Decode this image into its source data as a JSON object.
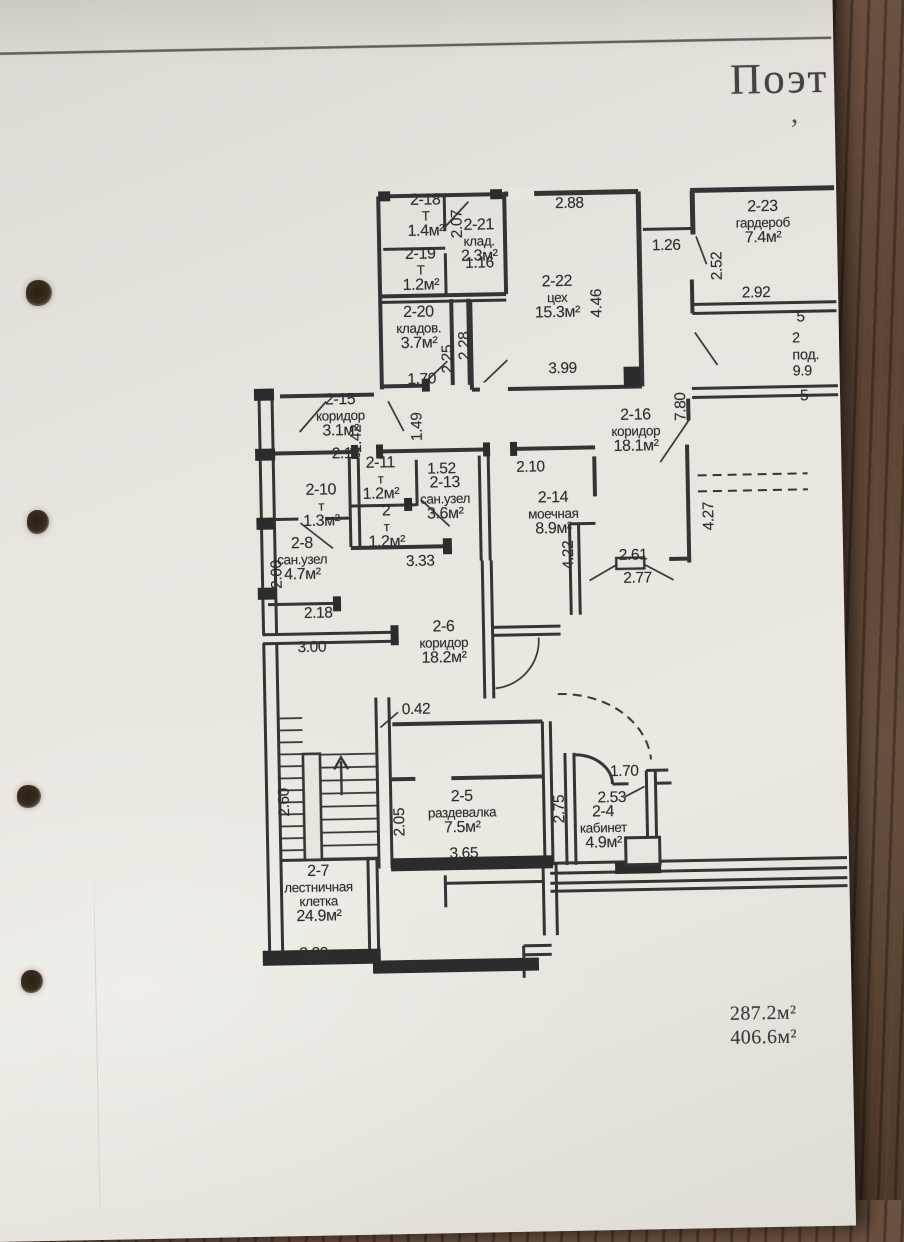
{
  "document": {
    "title_partial": "Поэт",
    "stray_mark": ",",
    "totals": {
      "line1": "287.2м²",
      "line2": "406.6м²"
    }
  },
  "plan": {
    "ink_color": "#343434",
    "rooms": [
      {
        "num": "2-18",
        "label": "Т",
        "area": "1.4м²",
        "x": 433,
        "y": 193
      },
      {
        "num": "2-19",
        "label": "Т",
        "area": "1.2м²",
        "x": 427,
        "y": 247
      },
      {
        "num": "2-21",
        "label": "клад.",
        "area": "2.3м²",
        "x": 486,
        "y": 219
      },
      {
        "num": "2-20",
        "label": "кладов.",
        "area": "3.7м²",
        "x": 424,
        "y": 305
      },
      {
        "num": "2-22",
        "label": "цех",
        "area": "15.3м²",
        "x": 563,
        "y": 277
      },
      {
        "num": "2-23",
        "label": "гардероб",
        "area": "7.4м²",
        "x": 770,
        "y": 206
      },
      {
        "num": "2-15",
        "label": "коридор",
        "area": "3.1м²",
        "x": 344,
        "y": 391
      },
      {
        "num": "2-16",
        "label": "коридор",
        "area": "18.1м²",
        "x": 639,
        "y": 412
      },
      {
        "num": "2-10",
        "label": "т",
        "area": "1.3м²",
        "x": 323,
        "y": 481
      },
      {
        "num": "2-11",
        "label": "т",
        "area": "1.2м²",
        "x": 383,
        "y": 455
      },
      {
        "num": "2-13",
        "label": "сан.узел",
        "area": "3.6м²",
        "x": 447,
        "y": 476
      },
      {
        "num": "2-14",
        "label": "моечная",
        "area": "8.9м²",
        "x": 555,
        "y": 493
      },
      {
        "num": "2",
        "label": "т",
        "area": "1.2м²",
        "x": 388,
        "y": 503
      },
      {
        "num": "2-8",
        "label": "сан.узел",
        "area": "4.7м²",
        "x": 303,
        "y": 534
      },
      {
        "num": "2-6",
        "label": "коридор",
        "area": "18.2м²",
        "x": 443,
        "y": 620
      },
      {
        "num": "2-5",
        "label": "раздевалка",
        "area": "7.5м²",
        "x": 458,
        "y": 790
      },
      {
        "num": "2-4",
        "label": "кабинет",
        "area": "4.9м²",
        "x": 599,
        "y": 808
      },
      {
        "num": "2-7",
        "label": "лестничная клетка",
        "area": "24.9м²",
        "x": 313,
        "y": 862
      }
    ],
    "partial_room": {
      "lines": [
        "2",
        "под.",
        "9.9"
      ],
      "x": 797,
      "y": 338
    },
    "dimensions": [
      {
        "text": "2.07",
        "x": 465,
        "y": 225,
        "rot": true
      },
      {
        "text": "1.16",
        "x": 486,
        "y": 265,
        "rot": false
      },
      {
        "text": "2.25",
        "x": 453,
        "y": 360,
        "rot": true
      },
      {
        "text": "2.28",
        "x": 470,
        "y": 347,
        "rot": true
      },
      {
        "text": "1.70",
        "x": 426,
        "y": 380,
        "rot": false
      },
      {
        "text": "2.88",
        "x": 577,
        "y": 207,
        "rot": false
      },
      {
        "text": "4.46",
        "x": 603,
        "y": 307,
        "rot": true
      },
      {
        "text": "3.99",
        "x": 567,
        "y": 372,
        "rot": false
      },
      {
        "text": "1.26",
        "x": 673,
        "y": 251,
        "rot": false
      },
      {
        "text": "2.52",
        "x": 724,
        "y": 272,
        "rot": true
      },
      {
        "text": "2.92",
        "x": 762,
        "y": 300,
        "rot": false
      },
      {
        "text": "5",
        "x": 806,
        "y": 325,
        "rot": false
      },
      {
        "text": "5",
        "x": 808,
        "y": 404,
        "rot": false
      },
      {
        "text": "2.18",
        "x": 349,
        "y": 453,
        "rot": false
      },
      {
        "text": "1.42",
        "x": 360,
        "y": 438,
        "rot": true
      },
      {
        "text": "1.49",
        "x": 421,
        "y": 427,
        "rot": true
      },
      {
        "text": "7.80",
        "x": 685,
        "y": 412,
        "rot": true
      },
      {
        "text": "1.52",
        "x": 444,
        "y": 470,
        "rot": false
      },
      {
        "text": "2.10",
        "x": 533,
        "y": 470,
        "rot": false
      },
      {
        "text": "3.33",
        "x": 421,
        "y": 562,
        "rot": false
      },
      {
        "text": "2.00",
        "x": 278,
        "y": 572,
        "rot": true
      },
      {
        "text": "2.18",
        "x": 318,
        "y": 612,
        "rot": false
      },
      {
        "text": "3.00",
        "x": 311,
        "y": 646,
        "rot": false
      },
      {
        "text": "4.22",
        "x": 570,
        "y": 558,
        "rot": true
      },
      {
        "text": "2.61",
        "x": 634,
        "y": 560,
        "rot": false
      },
      {
        "text": "2.77",
        "x": 638,
        "y": 583,
        "rot": false
      },
      {
        "text": "4.27",
        "x": 711,
        "y": 522,
        "rot": true
      },
      {
        "text": "0.42",
        "x": 414,
        "y": 710,
        "rot": false
      },
      {
        "text": "2.05",
        "x": 396,
        "y": 822,
        "rot": true
      },
      {
        "text": "3.65",
        "x": 459,
        "y": 855,
        "rot": false
      },
      {
        "text": "2.75",
        "x": 556,
        "y": 812,
        "rot": true
      },
      {
        "text": "1.70",
        "x": 621,
        "y": 776,
        "rot": false
      },
      {
        "text": "2.53",
        "x": 608,
        "y": 802,
        "rot": false
      },
      {
        "text": "2.60",
        "x": 281,
        "y": 800,
        "rot": true
      },
      {
        "text": "3.20",
        "x": 307,
        "y": 952,
        "rot": false
      }
    ]
  }
}
